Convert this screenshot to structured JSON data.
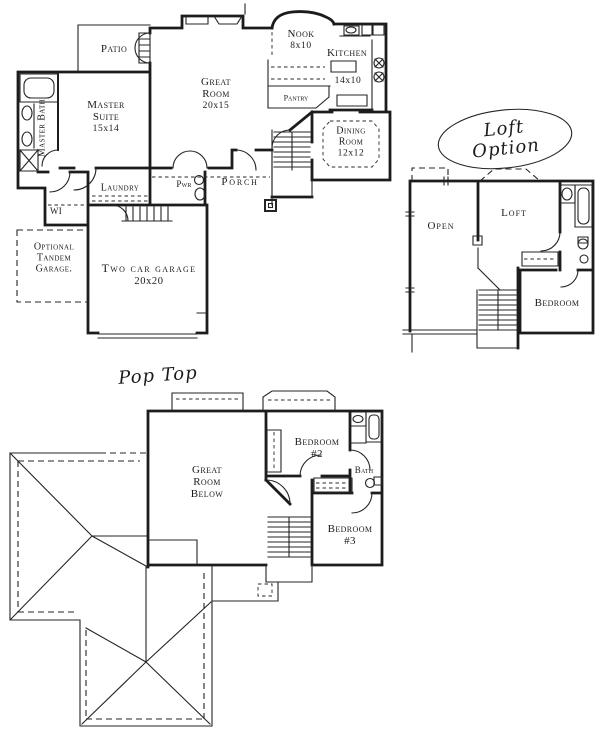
{
  "colors": {
    "ink": "#1c1c1c",
    "paper": "#ffffff"
  },
  "main_floor": {
    "rooms": {
      "patio": {
        "label": "Patio"
      },
      "master_suite": {
        "label": "Master\nSuite",
        "dims": "15x14"
      },
      "master_bath": {
        "label": "Master Bath"
      },
      "great_room": {
        "label": "Great\nRoom",
        "dims": "20x15"
      },
      "nook": {
        "label": "Nook",
        "dims": "8x10"
      },
      "kitchen": {
        "label": "Kitchen",
        "dims": "14x10"
      },
      "pantry": {
        "label": "Pantry"
      },
      "dining_room": {
        "label": "Dining\nRoom",
        "dims": "12x12"
      },
      "laundry": {
        "label": "Laundry"
      },
      "powder_room": {
        "label": "Pwr"
      },
      "porch": {
        "label": "Porch"
      },
      "walk_in_closet": {
        "label": "WI"
      },
      "optional_garage": {
        "label": "Optional\nTandem\nGarage."
      },
      "two_car_garage": {
        "label": "Two car garage",
        "dims": "20x20"
      }
    }
  },
  "loft_option": {
    "title": "Loft Option",
    "rooms": {
      "open": {
        "label": "Open"
      },
      "loft": {
        "label": "Loft"
      },
      "bedroom": {
        "label": "Bedroom"
      }
    }
  },
  "pop_top": {
    "title": "Pop Top",
    "rooms": {
      "great_room_below": {
        "label": "Great\nRoom\nBelow"
      },
      "bedroom_2": {
        "label": "Bedroom\n#2"
      },
      "bath": {
        "label": "Bath"
      },
      "bedroom_3": {
        "label": "Bedroom\n#3"
      }
    }
  }
}
